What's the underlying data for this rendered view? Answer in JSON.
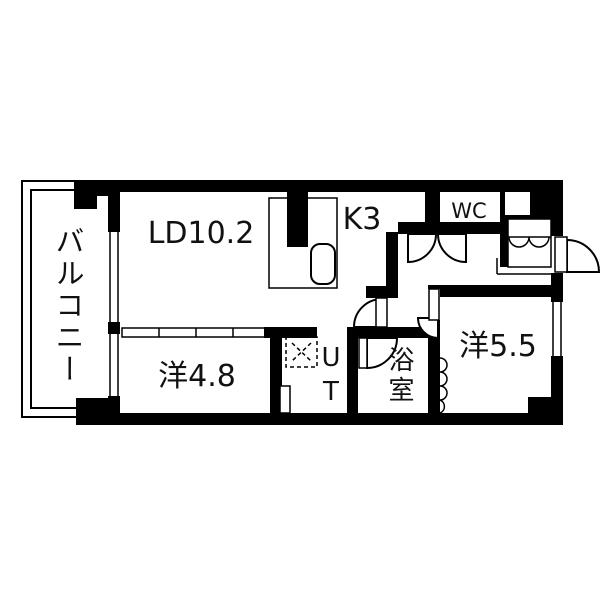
{
  "colors": {
    "wall": "#000000",
    "background": "#ffffff",
    "line": "#000000"
  },
  "floorplan": {
    "labels": {
      "balcony": "バルコニー",
      "living_dining": "LD10.2",
      "kitchen": "K3",
      "toilet": "WC",
      "western_room_1": "洋4.8",
      "utility": "UT",
      "bath": "浴室",
      "western_room_2": "洋5.5"
    }
  }
}
